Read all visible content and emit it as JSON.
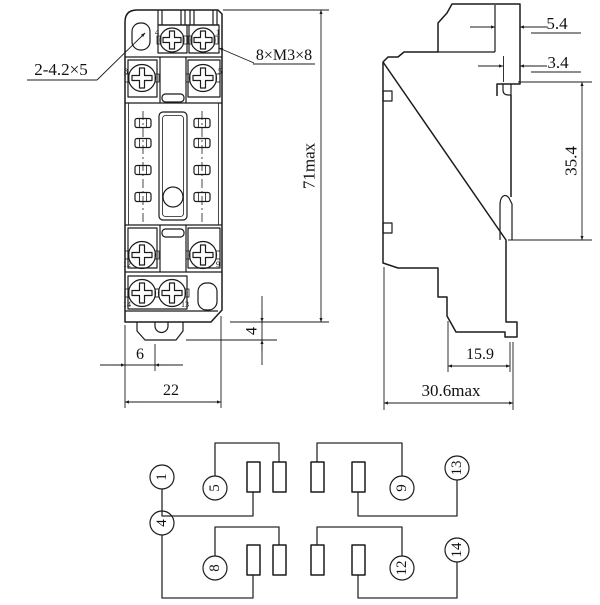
{
  "front_view": {
    "callouts": {
      "mounting_holes": "2-4.2×5",
      "terminal_screws": "8×M3×8"
    },
    "terminals": {
      "t1": "1",
      "t4": "4",
      "t5": "5",
      "t8": "8",
      "t9": "9",
      "t12": "12",
      "t13": "13",
      "t14": "14"
    },
    "dims": {
      "overall_height": "71max",
      "overall_width": "22",
      "clip_projection": "4",
      "clip_offset": "6"
    }
  },
  "side_view": {
    "dims": {
      "top_hook_width": "5.4",
      "rail_lip": "3.4",
      "rail_opening": "35.4",
      "lower_depth": "15.9",
      "overall_depth": "30.6max"
    }
  },
  "schematic": {
    "terminals": [
      "1",
      "5",
      "9",
      "13",
      "4",
      "8",
      "12",
      "14"
    ]
  },
  "colors": {
    "line": "#1b1b1b",
    "background": "#ffffff"
  }
}
